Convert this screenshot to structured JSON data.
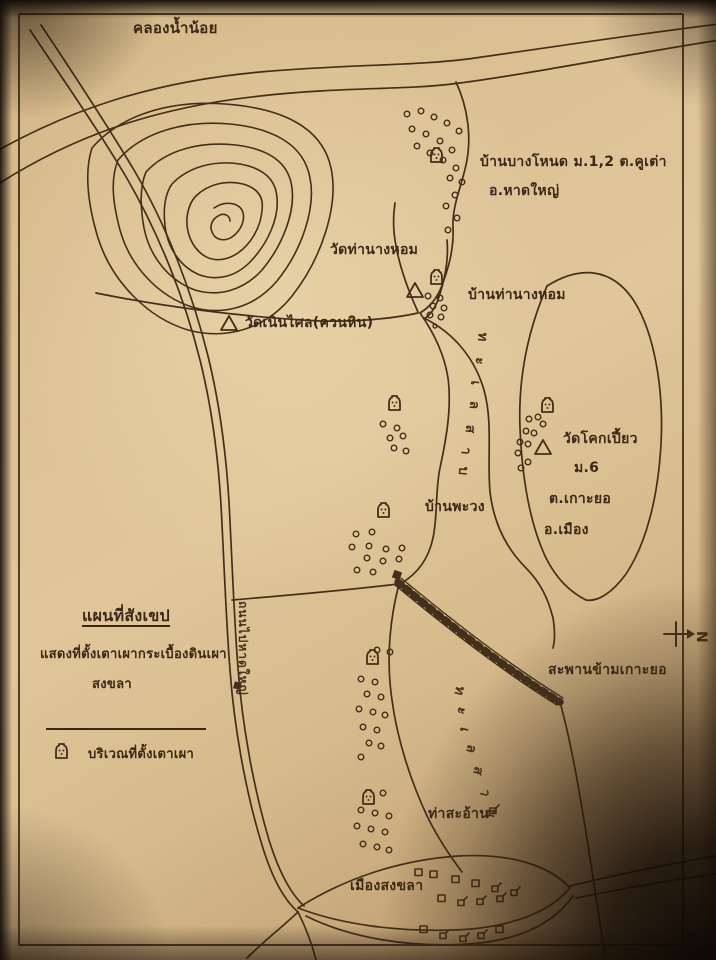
{
  "document": {
    "kind": "hand-drawn sketch map photograph",
    "language": "Thai",
    "subject": "Location of pottery/tile kiln sites, Songkhla"
  },
  "colors": {
    "paper": "#dcc196",
    "ink": "#43301b",
    "shadow": "#160d06"
  },
  "labels": {
    "canal": "คลองน้ำน้อย",
    "village_bang_nod_line1": "บ้านบางโหนด ม.1,2 ต.คูเต่า",
    "village_bang_nod_line2": "อ.หาดใหญ่",
    "wat_tha_nang_hom": "วัดท่านางหอม",
    "ban_tha_nang_hom": "บ้านท่านางหอม",
    "wat_noen_salai": "วัดเนินไศล(ควนหิน)",
    "wat_khok_piao": "วัดโคกเปี้ยว",
    "wat_khok_piao_moo": "ม.6",
    "wat_khok_piao_tambon": "ต.เกาะยอ",
    "wat_khok_piao_amphoe": "อ.เมือง",
    "ban_phawong": "บ้านพะวง",
    "bridge": "สะพานข้ามเกาะยอ",
    "tha_sa_an": "ท่าสะอ้าน",
    "mueang_songkhla": "เมืองสงขลา",
    "road": "ถนนไปหาดใหญ่",
    "lake": {
      "word": "ทะเลสาบ",
      "letters": [
        "ท",
        "ะ",
        "เ",
        "ล",
        "ส",
        "า",
        "บ"
      ]
    }
  },
  "legend": {
    "title": "แผนที่สังเขป",
    "line1": "แสดงที่ตั้งเตาเผากระเบื้องดินเผา",
    "line2": "สงขลา",
    "kiln_item": "บริเวณที่ตั้งเตาเผา"
  },
  "compass": {
    "label": "N",
    "points": "right"
  },
  "symbols": {
    "kiln": "kiln-mound-icon",
    "temple": "triangle-temple-icon",
    "house": "house-square-icon",
    "kiln_site_dots": "small-circle-cluster"
  }
}
